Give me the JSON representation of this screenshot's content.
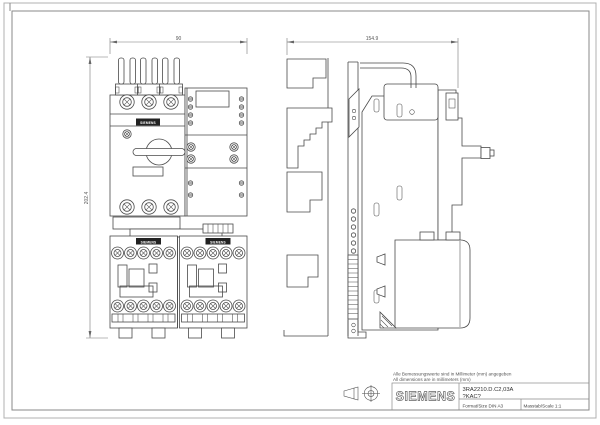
{
  "page": {
    "dimensions": {
      "front_width": "90",
      "side_width": "154.9",
      "front_height": "202.4"
    },
    "device_labels": {
      "breaker_label": "SIEMENS",
      "contactor_left_label": "SIEMENS",
      "contactor_right_label": "SIEMENS"
    },
    "notes": {
      "line_de": "Alle Bemessungswerte sind in Millimeter (mm) angegeben",
      "line_en": "All dimensions are in millimeters (mm)"
    },
    "title_block": {
      "brand": "SIEMENS",
      "product_line1": "3RA2210.D.C2,03A",
      "product_line2": "?KAC?",
      "format_label": "Format/Size DIN A3",
      "scale_label": "Masstab/Scale 1:1"
    },
    "colors": {
      "line": "#4a4a4a",
      "dim_line": "#777777",
      "frame_outer": "#b0b0b0",
      "frame_inner": "#8a8a8a",
      "background": "#ffffff",
      "label_fill": "#222222"
    }
  }
}
